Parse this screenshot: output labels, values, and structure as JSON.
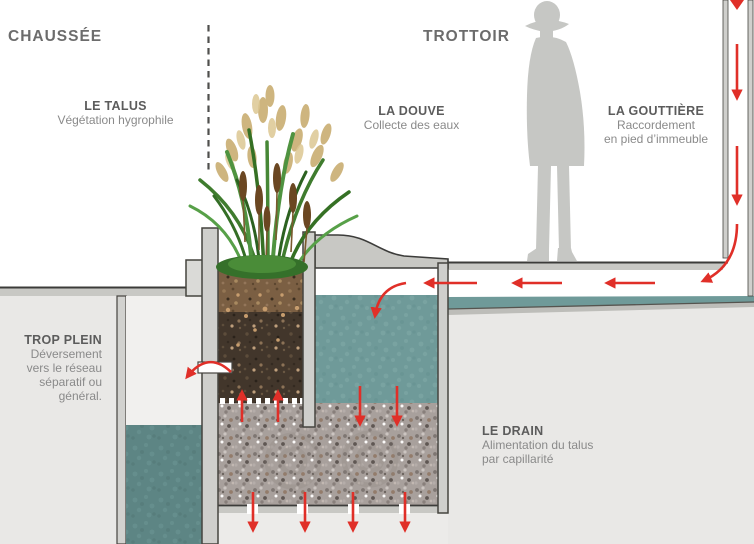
{
  "zones": {
    "chaussee": "CHAUSSÉE",
    "trottoir": "TROTTOIR"
  },
  "labels": {
    "talus": {
      "title": "LE TALUS",
      "desc": "Végétation hygrophile"
    },
    "douve": {
      "title": "LA DOUVE",
      "desc": "Collecte des eaux"
    },
    "gouttiere": {
      "title": "LA GOUTTIÈRE",
      "desc": "Raccordement\nen pied d’immeuble"
    },
    "trop_plein": {
      "title": "TROP PLEIN",
      "desc": "Déversement\nvers le réseau\nséparatif ou\ngénéral."
    },
    "drain": {
      "title": "LE DRAIN",
      "desc": "Alimentation du talus\npar capillarité"
    }
  },
  "figures": {
    "pedestrian": "pedestrian-silhouette",
    "vegetation": "cattail-reed-clump"
  },
  "colors": {
    "arrow_red": "#e02f28",
    "water_teal": "#6f9a99",
    "deep_water_teal": "#5d8584",
    "concrete_light": "#e9e8e6",
    "concrete_mid": "#c8c8c4",
    "wall_gray": "#cfcfcc",
    "silhouette_gray": "#c6c7c4",
    "topsoil_brown": "#7b5f43",
    "subsoil_brown": "#42362b",
    "gravel_gray": "#a8a09c",
    "heading_text": "#6c6c6c",
    "label_title_text": "#5c5c5c",
    "label_desc_text": "#8a8a8a"
  }
}
